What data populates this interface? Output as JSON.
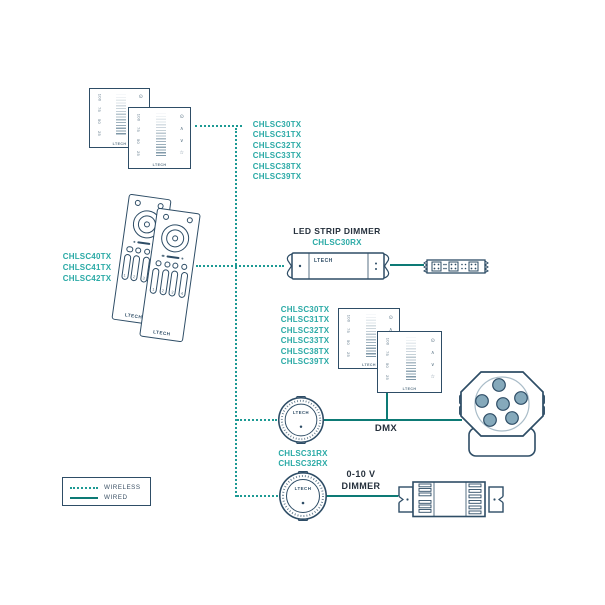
{
  "brand": "LTECH",
  "colors": {
    "outline": "#2e4d66",
    "wired_line": "#0d7a75",
    "wireless_line": "#1d9a94",
    "model_text": "#2baaa6",
    "heading_text": "#25303c"
  },
  "legend": {
    "wireless_label": "WIRELESS",
    "wired_label": "WIRED"
  },
  "wall_panel_tx_models": [
    "CHLSC30TX",
    "CHLSC31TX",
    "CHLSC32TX",
    "CHLSC33TX",
    "CHLSC38TX",
    "CHLSC39TX"
  ],
  "remote_tx_models": [
    "CHLSC40TX",
    "CHLSC41TX",
    "CHLSC42TX"
  ],
  "led_strip_dimmer": {
    "title": "LED STRIP DIMMER",
    "model": "CHLSC30RX"
  },
  "knob_rx_models": [
    "CHLSC31RX",
    "CHLSC32RX"
  ],
  "dmx_label": "DMX",
  "dimmer_0_10v": {
    "line1": "0-10 V",
    "line2": "DIMMER"
  },
  "panel_scale_labels": [
    "100",
    "75",
    "50",
    "25"
  ],
  "panel_icons": {
    "power": "⊙",
    "up": "∧",
    "down": "∨",
    "scene": "☆"
  },
  "remote_zone_keys": [
    "1",
    "2",
    "3",
    "4"
  ]
}
